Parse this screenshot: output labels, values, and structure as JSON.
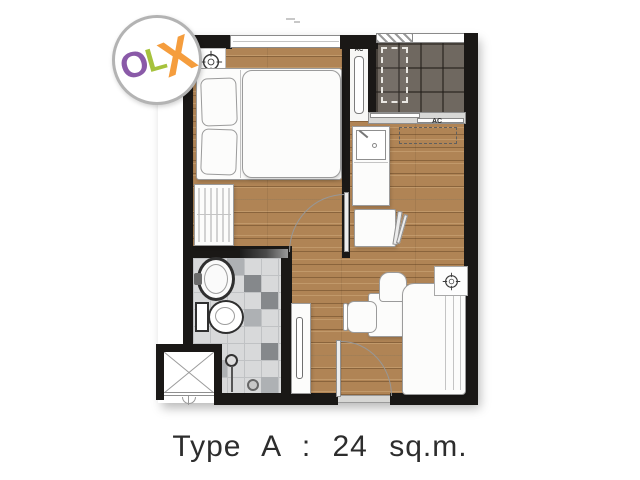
{
  "watermark": {
    "brand": "OLX",
    "letters": [
      {
        "char": "O",
        "color": "#8a5aa8"
      },
      {
        "char": "L",
        "color": "#a6c23c"
      },
      {
        "char": "X",
        "color": "#f59d3d"
      }
    ]
  },
  "plan": {
    "labels": {
      "bedroom_ac": "AC",
      "living_ac": "AC"
    }
  },
  "caption": "Type A : 24 sq.m.",
  "colors": {
    "wall": "#1a1816",
    "wood_floor": "#b08455",
    "balcony_tile": "#6f6860",
    "bathroom_tile": "#d8d9da",
    "bathroom_tile_dark": "#85888b",
    "caption_text": "#2d2d2d"
  }
}
